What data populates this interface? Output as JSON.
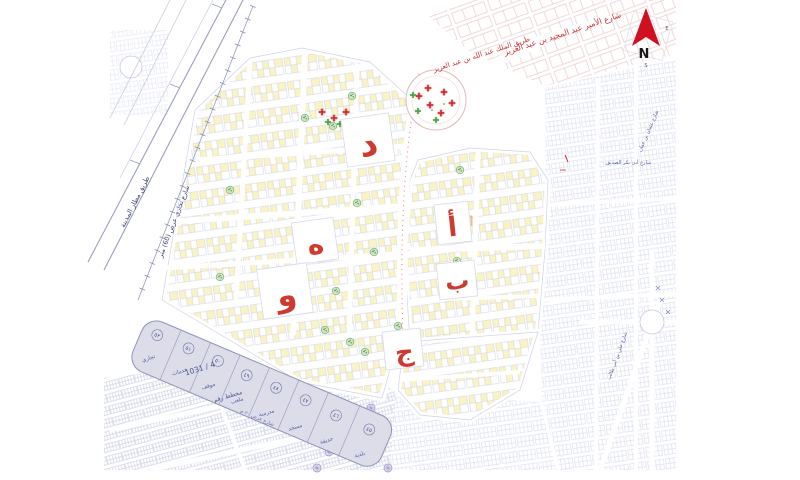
{
  "map_title": "urban-subdivision-plan",
  "compass": {
    "north": "N",
    "east": "E",
    "south": "S"
  },
  "zones": {
    "dal": "د",
    "ha": "ه",
    "waw": "و",
    "alif": "أ",
    "ba": "ب",
    "jim": "ج"
  },
  "streets": {
    "airport_road": "طريق مطار المدينة",
    "commercial": "شارع تجاري عرض (60) متر",
    "top_red_1": "شارع الأمير عبد المجيد بن عبد العزيز",
    "top_red_2": "طريق الملك عبد الله بن عبد العزيز",
    "east_1": "شارع عثمان بن عفان",
    "east_2": "شارع أبي بكر الصديق",
    "east_3": "شارع علي بن أبي طالب",
    "south_strip": "شارع عرض ٢٠ م"
  },
  "strip": {
    "plan_label": "مخطط رقم",
    "plan_number": "1031 / 4",
    "plots": [
      {
        "number": "٥٢",
        "label": "تجاري"
      },
      {
        "number": "٥١",
        "label": "خدمات"
      },
      {
        "number": "٥٠",
        "label": "موقف"
      },
      {
        "number": "٤٩",
        "label": "ملعب"
      },
      {
        "number": "٤٨",
        "label": "مدرسة"
      },
      {
        "number": "٤٧",
        "label": "مسجد"
      },
      {
        "number": "٤٦",
        "label": "حديقة"
      },
      {
        "number": "٤٥",
        "label": "بلدية"
      }
    ]
  },
  "colors": {
    "zone_letter_red": "#cf3a30",
    "parcel_yellow": "#faf3c4",
    "parcel_line_lavender": "#cdd0e6",
    "strip_gray": "#dcdde9",
    "tree_green": "#74b36e",
    "flower_red": "#d94040",
    "street_text_blue": "#5560a8",
    "pink_block_line": "#e4bcbc",
    "compass_red": "#cf1020"
  }
}
